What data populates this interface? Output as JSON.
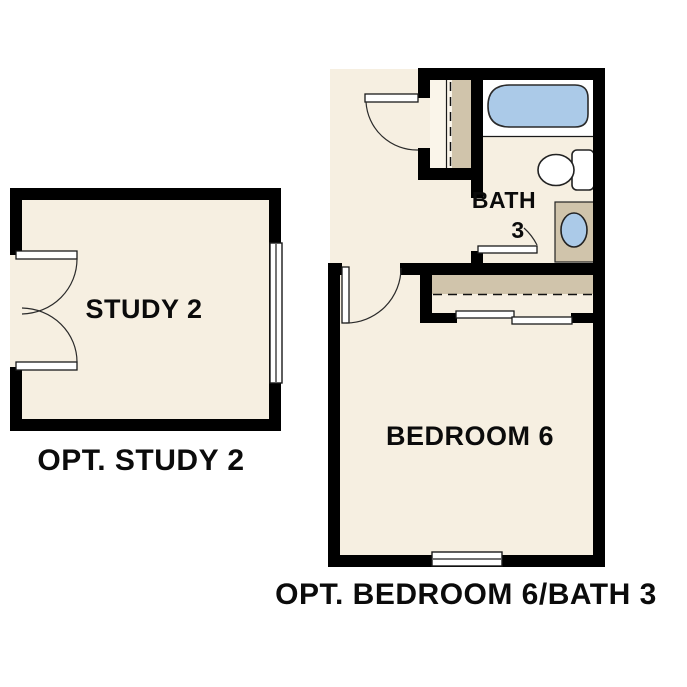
{
  "title": "Optional rooms floor plan",
  "colors": {
    "background": "#ffffff",
    "floor": "#f6efe1",
    "wall": "#000000",
    "closet_shading": "#d0c4ab",
    "closet_interior": "#faf5ea",
    "fixture_white": "#ffffff",
    "water_blue": "#abcae8",
    "text": "#0b0b0b"
  },
  "study": {
    "room_label": "STUDY 2",
    "caption": "OPT. STUDY 2"
  },
  "suite": {
    "bath_label": "BATH",
    "bath_number": "3",
    "bedroom_label": "BEDROOM 6",
    "caption": "OPT. BEDROOM 6/BATH 3"
  }
}
